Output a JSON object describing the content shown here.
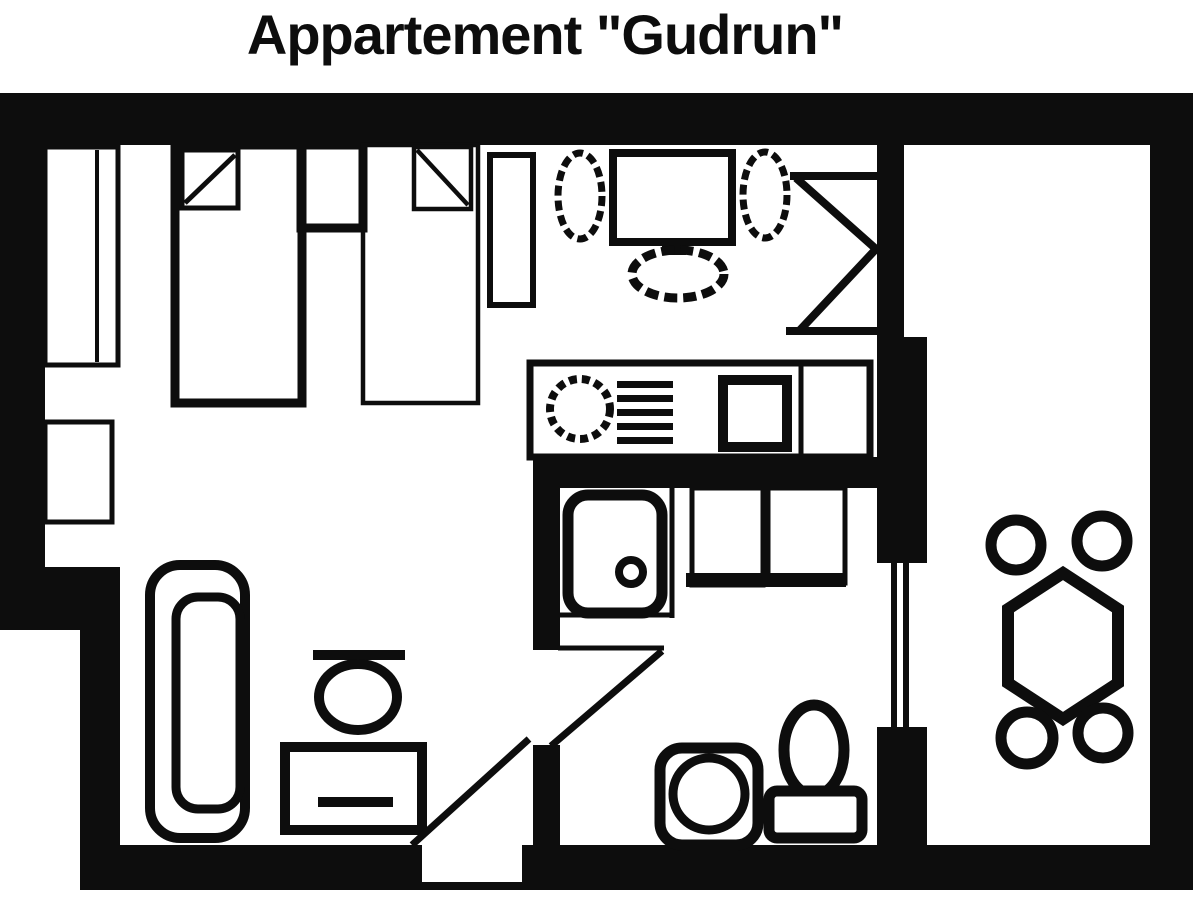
{
  "title": "Appartement \"Gudrun\"",
  "colors": {
    "ink": "#0d0d0d",
    "paper": "#ffffff"
  },
  "floorplan": {
    "rooms": [
      {
        "name": "sleeping-area",
        "fixtures": [
          "wall-wardrobe",
          "wall-closet",
          "single-bed-1-with-pillow",
          "nightstand",
          "single-bed-2-with-pillow"
        ]
      },
      {
        "name": "living-area",
        "fixtures": [
          "tall-shelf",
          "plant-left",
          "tv-with-stand",
          "plant-right",
          "oval-rug",
          "folding-door-wardrobe",
          "sofa",
          "armchair",
          "coffee-table"
        ]
      },
      {
        "name": "kitchenette",
        "fixtures": [
          "kitchen-counter",
          "round-sink",
          "drainer-grill",
          "hob-square"
        ]
      },
      {
        "name": "bathroom",
        "fixtures": [
          "shower-tray-with-drain",
          "cabinet-left",
          "cabinet-right",
          "washbasin",
          "toilet"
        ]
      },
      {
        "name": "terrace",
        "fixtures": [
          "hexagonal-table",
          "chair-top-left",
          "chair-top-right",
          "chair-bottom-left",
          "chair-bottom-right"
        ],
        "window": "double-glazed-window-symbol"
      }
    ],
    "doors": [
      "entrance-door-swing",
      "bathroom-door-swing",
      "terrace-passage"
    ]
  }
}
